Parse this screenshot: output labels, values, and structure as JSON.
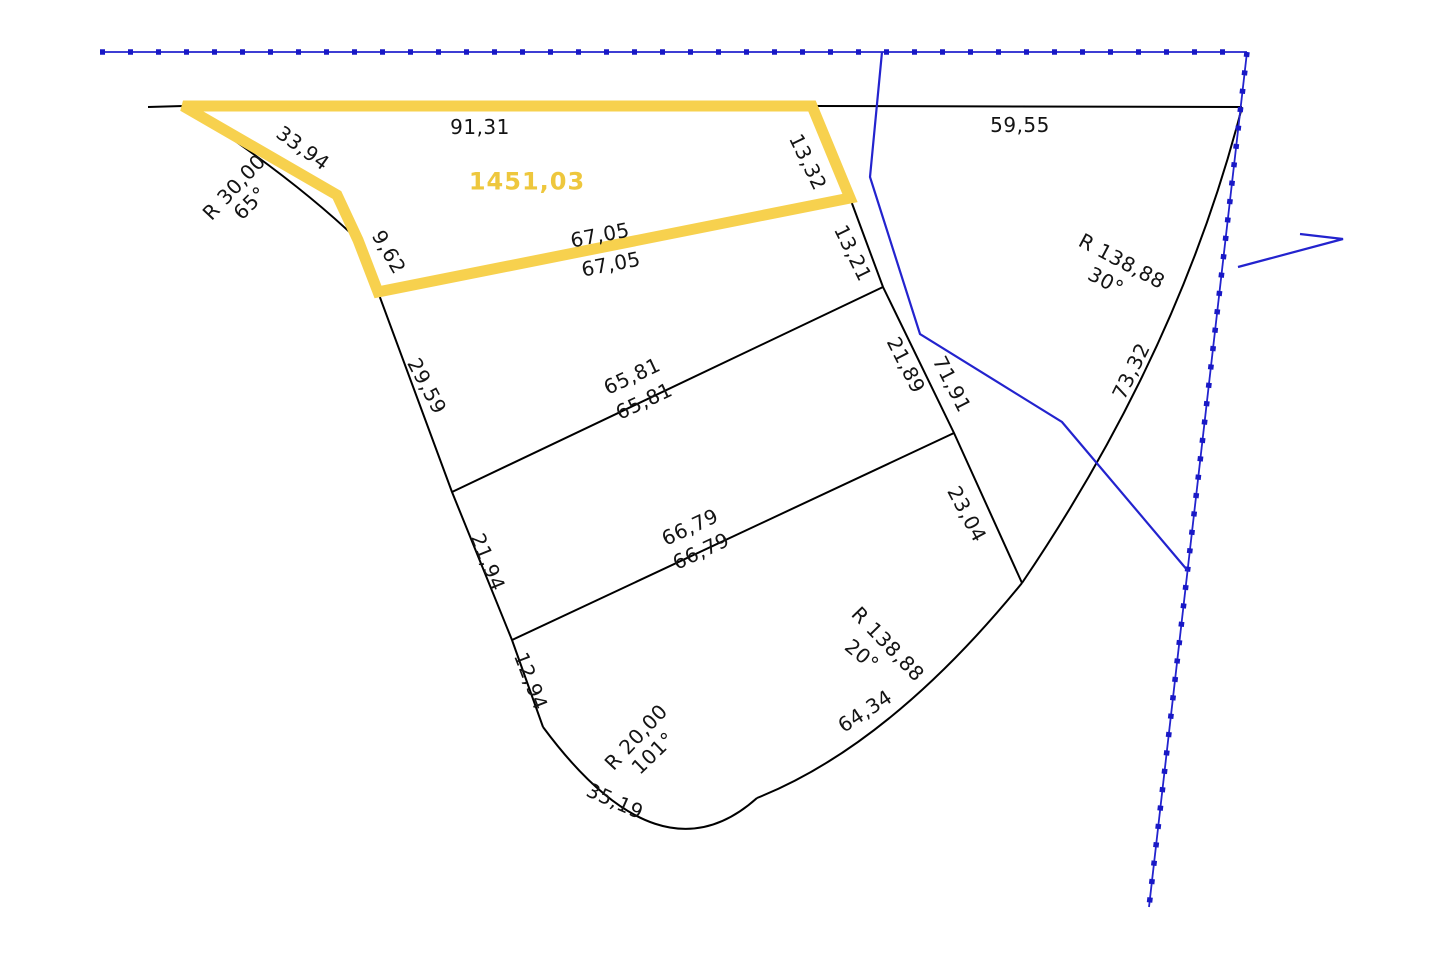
{
  "area": {
    "value": "1451,03"
  },
  "dimensions": {
    "d91_31": "91,31",
    "d59_55": "59,55",
    "d33_94": "33,94",
    "d9_62": "9,62",
    "d67_05a": "67,05",
    "d67_05b": "67,05",
    "d13_32": "13,32",
    "d13_21": "13,21",
    "d21_89": "21,89",
    "d71_91": "71,91",
    "d23_04": "23,04",
    "d29_59": "29,59",
    "d65_81a": "65,81",
    "d65_81b": "65,81",
    "d21_94": "21,94",
    "d66_79a": "66,79",
    "d66_79b": "66,79",
    "d12_94": "12,94",
    "d35_19": "35,19",
    "d64_34": "64,34",
    "d73_32": "73,32"
  },
  "radii": {
    "upper_left": {
      "radius": "R 30,00",
      "angle": "65°"
    },
    "right": {
      "radius": "R 138,88",
      "angle": "30°"
    },
    "bottom": {
      "radius": "R 138,88",
      "angle": "20°"
    },
    "tip": {
      "radius": "R 20,00",
      "angle": "101°"
    }
  },
  "colors": {
    "highlight": "#F7D14E",
    "area_text": "#EEC73D",
    "boundary": "#000000",
    "utility": "#2323CE",
    "beads": "#1818C6",
    "background": "#FFFFFF"
  }
}
